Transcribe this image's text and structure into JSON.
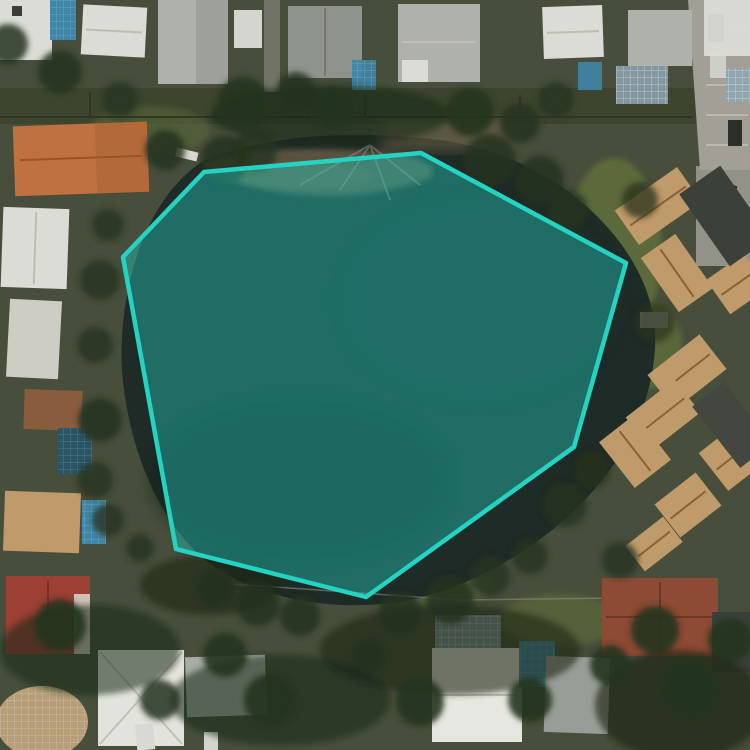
{
  "map": {
    "view": "satellite-aerial",
    "overlay": {
      "shape": "polygon",
      "points": [
        [
          204,
          172
        ],
        [
          421,
          153
        ],
        [
          626,
          263
        ],
        [
          574,
          447
        ],
        [
          366,
          597
        ],
        [
          176,
          549
        ],
        [
          123,
          257
        ]
      ],
      "stroke_color": "#25d3c3",
      "stroke_width": 4.5,
      "fill_color": "#20c9bc",
      "fill_opacity": 0.42
    },
    "features": [
      "pond",
      "tree-canopy",
      "single-family-houses",
      "townhouse-cluster",
      "screened-swimming-pools",
      "parking-lot",
      "backyard-fences"
    ],
    "palette": {
      "ground": "#474e3b",
      "yard": "#3c452e",
      "water": "#1f2b26",
      "canopy": "#26331e",
      "canopy-dark": "#1a2415",
      "grass": "#5f6e3b",
      "sand": "#6e6147",
      "roof-white": "#dcdcd6",
      "roof-gray": "#aeb1ac",
      "roof-darkgray": "#8f938d",
      "roof-orange": "#c07140",
      "roof-red": "#9c3f34",
      "roof-brown": "#8d4a34",
      "roof-tan": "#bf9a6a",
      "roof-charcoal": "#3b403b",
      "pool": "#3f86a8",
      "screen": "#8fa6b4",
      "pavement": "#a19f96",
      "fence": "#2b3328"
    }
  }
}
